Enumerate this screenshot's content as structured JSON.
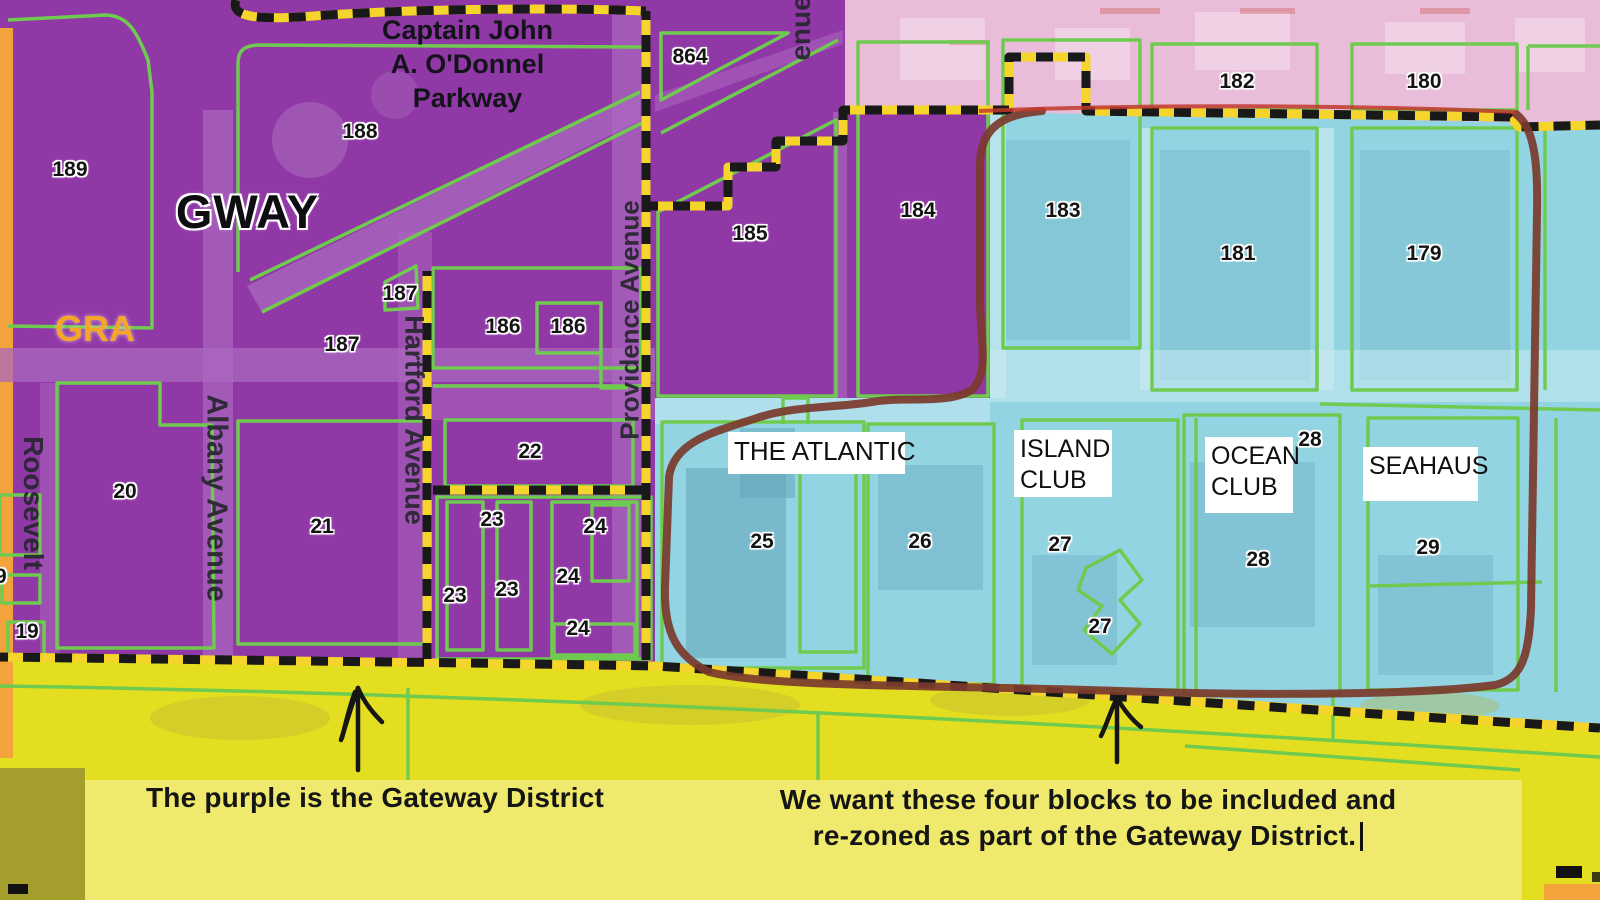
{
  "colors": {
    "purple_zone": "#9138A7",
    "purple_road": "#AB68BF",
    "pink_zone": "#E9BDDA",
    "cyan_zone": "#92D4E2",
    "cyan_building": "#5D9FB6",
    "yellow_zone": "#E4DE20",
    "caption_band": "#EFEA6D",
    "green_line": "#6FCB4F",
    "boundary_yellow": "#F5D42B",
    "boundary_black": "#191919",
    "brown_loop": "#7B3A2C",
    "red_line": "#C23A2B",
    "orange_strip": "#F2A33C",
    "label_ink": "#141414",
    "street_ink": "#26262E",
    "gra_orange": "#F5A62A",
    "white": "#FFFFFF"
  },
  "area_labels": {
    "gway": "GWAY",
    "gra": "GRA"
  },
  "parkway": {
    "line1": "Captain John",
    "line2": "A. O'Donnel",
    "line3": "Parkway"
  },
  "buildings": [
    {
      "line1": "THE ATLANTIC",
      "line2": ""
    },
    {
      "line1": "ISLAND",
      "line2": "CLUB"
    },
    {
      "line1": "OCEAN",
      "line2": "CLUB"
    },
    {
      "line1": "SEAHAUS",
      "line2": ""
    }
  ],
  "captions": {
    "left": "The purple is the Gateway District",
    "right1": "We want these four blocks to be included and",
    "right2": "re-zoned as part of the Gateway District."
  },
  "street_labels": [
    {
      "text": "Roosevelt",
      "x": 33,
      "y": 503,
      "rotate": 90,
      "size": 28
    },
    {
      "text": "Albany Avenue",
      "x": 216,
      "y": 498,
      "rotate": 90,
      "size": 29
    },
    {
      "text": "Hartford Avenue",
      "x": 414,
      "y": 420,
      "rotate": 90,
      "size": 27
    },
    {
      "text": "Providence Avenue",
      "x": 630,
      "y": 320,
      "rotate": -90,
      "size": 26
    },
    {
      "text": "enue",
      "x": 801,
      "y": 28,
      "rotate": -90,
      "size": 28
    }
  ],
  "parcel_labels": [
    {
      "text": "189",
      "x": 70,
      "y": 170
    },
    {
      "text": "188",
      "x": 360,
      "y": 132
    },
    {
      "text": "187",
      "x": 400,
      "y": 294
    },
    {
      "text": "187",
      "x": 342,
      "y": 345
    },
    {
      "text": "186",
      "x": 503,
      "y": 327
    },
    {
      "text": "186",
      "x": 568,
      "y": 327
    },
    {
      "text": "864",
      "x": 690,
      "y": 57
    },
    {
      "text": "185",
      "x": 750,
      "y": 234
    },
    {
      "text": "184",
      "x": 918,
      "y": 211
    },
    {
      "text": "183",
      "x": 1063,
      "y": 211
    },
    {
      "text": "182",
      "x": 1237,
      "y": 82
    },
    {
      "text": "180",
      "x": 1424,
      "y": 82
    },
    {
      "text": "181",
      "x": 1238,
      "y": 254
    },
    {
      "text": "179",
      "x": 1424,
      "y": 254
    },
    {
      "text": "20",
      "x": 125,
      "y": 492
    },
    {
      "text": "21",
      "x": 322,
      "y": 527
    },
    {
      "text": "22",
      "x": 530,
      "y": 452
    },
    {
      "text": "23",
      "x": 492,
      "y": 520
    },
    {
      "text": "23",
      "x": 455,
      "y": 596
    },
    {
      "text": "23",
      "x": 507,
      "y": 590
    },
    {
      "text": "24",
      "x": 595,
      "y": 527
    },
    {
      "text": "24",
      "x": 568,
      "y": 577
    },
    {
      "text": "24",
      "x": 578,
      "y": 629
    },
    {
      "text": "19",
      "x": -5,
      "y": 577
    },
    {
      "text": "19",
      "x": 27,
      "y": 632
    },
    {
      "text": "25",
      "x": 762,
      "y": 542
    },
    {
      "text": "26",
      "x": 920,
      "y": 542
    },
    {
      "text": "27",
      "x": 1060,
      "y": 545
    },
    {
      "text": "27",
      "x": 1100,
      "y": 627
    },
    {
      "text": "28",
      "x": 1310,
      "y": 440
    },
    {
      "text": "28",
      "x": 1258,
      "y": 560
    },
    {
      "text": "29",
      "x": 1428,
      "y": 548
    }
  ]
}
